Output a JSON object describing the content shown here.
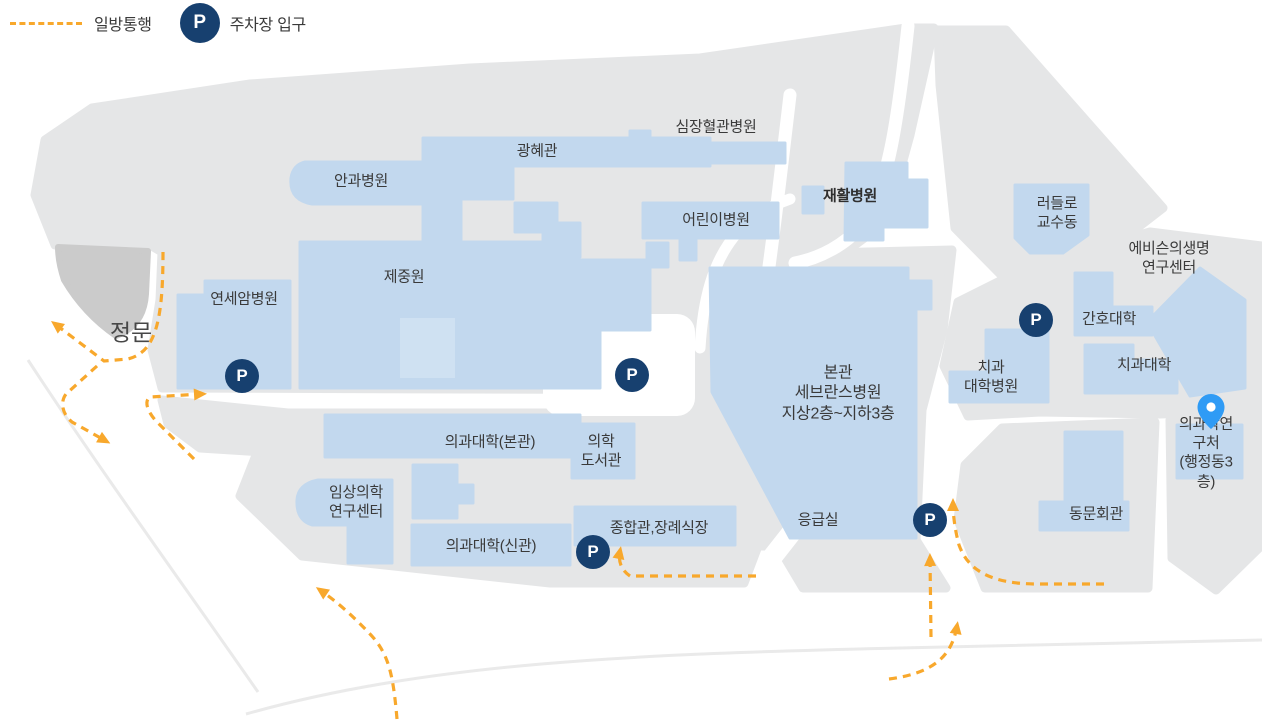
{
  "legend": {
    "one_way_label": "일방통행",
    "parking_symbol": "P",
    "parking_label": "주차장 입구"
  },
  "colors": {
    "region_gray": "#E5E6E7",
    "gate_wedge_gray": "#CBCBCB",
    "building_blue": "#C2D8EE",
    "parking_navy": "#17406F",
    "route_orange": "#F8A82C",
    "pin_blue": "#2F9BF5",
    "label_text": "#3A3A3A"
  },
  "map": {
    "parking_symbol": "P",
    "labels": [
      {
        "id": "cardio-hospital",
        "text": "심장혈관병원",
        "x": 716,
        "y": 127
      },
      {
        "id": "gwanghye-hall",
        "text": "광혜관",
        "x": 537,
        "y": 151
      },
      {
        "id": "eye-hospital",
        "text": "안과병원",
        "x": 361,
        "y": 181
      },
      {
        "id": "children-hospital",
        "text": "어린이병원",
        "x": 716,
        "y": 220
      },
      {
        "id": "rehab-hospital",
        "text": "재활병원",
        "x": 850,
        "y": 196,
        "bold": true
      },
      {
        "id": "ludlow-faculty-bldg",
        "text": "러들로\n교수동",
        "x": 1057,
        "y": 213
      },
      {
        "id": "avison-biomed-center",
        "text": "에비슨의생명연구센터",
        "x": 1169,
        "y": 258
      },
      {
        "id": "jejungwon",
        "text": "제중원",
        "x": 404,
        "y": 277
      },
      {
        "id": "yonsei-cancer-hospital",
        "text": "연세암병원",
        "x": 244,
        "y": 299
      },
      {
        "id": "main-gate",
        "text": "정문",
        "x": 131,
        "y": 333,
        "gate": true
      },
      {
        "id": "nursing-college",
        "text": "간호대학",
        "x": 1109,
        "y": 319
      },
      {
        "id": "dental-hospital",
        "text": "치과\n대학병원",
        "x": 991,
        "y": 377
      },
      {
        "id": "dental-college",
        "text": "치과대학",
        "x": 1144,
        "y": 365
      },
      {
        "id": "main-severance",
        "text": "본관\n세브란스병원\n지상2층~지하3층",
        "x": 838,
        "y": 394,
        "big": true
      },
      {
        "id": "med-research-office",
        "text": "의과학연구처\n(행정동3층)",
        "x": 1206,
        "y": 453
      },
      {
        "id": "med-college-main",
        "text": "의과대학(본관)",
        "x": 490,
        "y": 442
      },
      {
        "id": "medical-library",
        "text": "의학\n도서관",
        "x": 601,
        "y": 451
      },
      {
        "id": "clinical-research-center",
        "text": "임상의학\n연구센터",
        "x": 356,
        "y": 502
      },
      {
        "id": "med-college-new",
        "text": "의과대학(신관)",
        "x": 491,
        "y": 546
      },
      {
        "id": "jonghap-funeral-hall",
        "text": "종합관,장례식장",
        "x": 659,
        "y": 528
      },
      {
        "id": "emergency-room",
        "text": "응급실",
        "x": 818,
        "y": 520
      },
      {
        "id": "alumni-hall",
        "text": "동문회관",
        "x": 1096,
        "y": 514
      }
    ],
    "parking_entrances": [
      {
        "id": "parking-cancer",
        "x": 242,
        "y": 376
      },
      {
        "id": "parking-plaza",
        "x": 632,
        "y": 375
      },
      {
        "id": "parking-nursing",
        "x": 1036,
        "y": 320
      },
      {
        "id": "parking-emergency",
        "x": 930,
        "y": 520
      },
      {
        "id": "parking-jonghap",
        "x": 593,
        "y": 552
      }
    ],
    "destination_pin": {
      "x": 1211,
      "y": 434,
      "points_to": "의과학연구처 (행정동3층)"
    }
  }
}
